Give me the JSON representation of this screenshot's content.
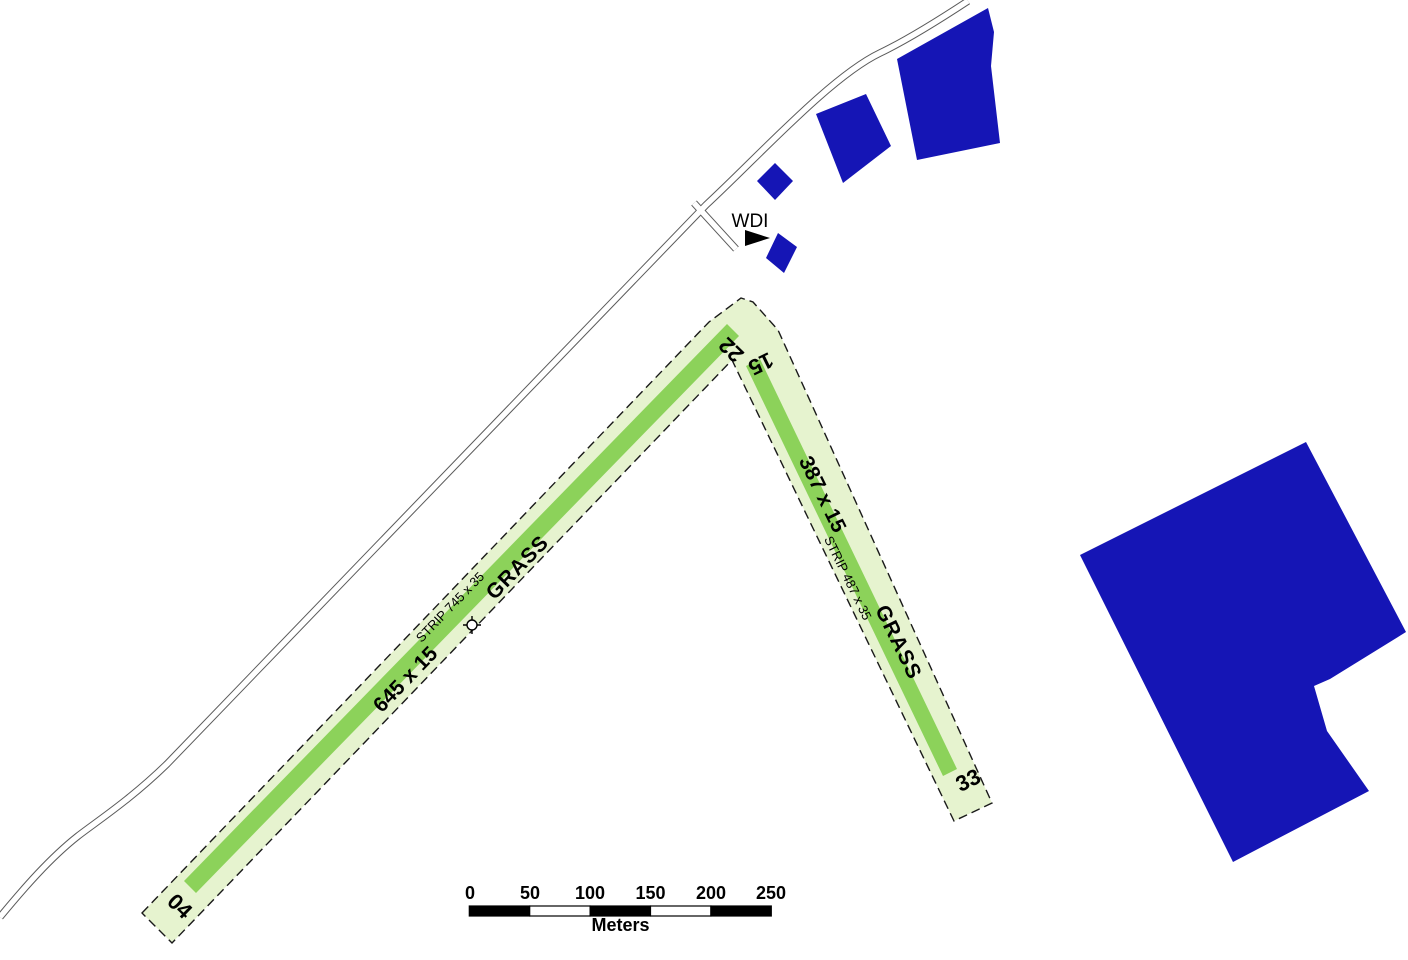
{
  "wdi": {
    "label": "WDI"
  },
  "runways": [
    {
      "designator_low": "04",
      "designator_high": "22",
      "dimensions": "645 x 15",
      "surface": "GRASS",
      "strip_label": "STRIP 745 x 35"
    },
    {
      "designator_low": "15",
      "designator_high": "33",
      "dimensions": "387 x 15",
      "surface": "GRASS",
      "strip_label": "STRIP 487 x 35"
    }
  ],
  "scalebar": {
    "ticks": [
      "0",
      "50",
      "100",
      "150",
      "200",
      "250"
    ],
    "unit": "Meters"
  },
  "colors": {
    "building": "#1515b5",
    "runway": "#8cd25a",
    "strip": "#e6f3cf",
    "scale_dark": "#000000",
    "scale_light": "#ffffff"
  }
}
